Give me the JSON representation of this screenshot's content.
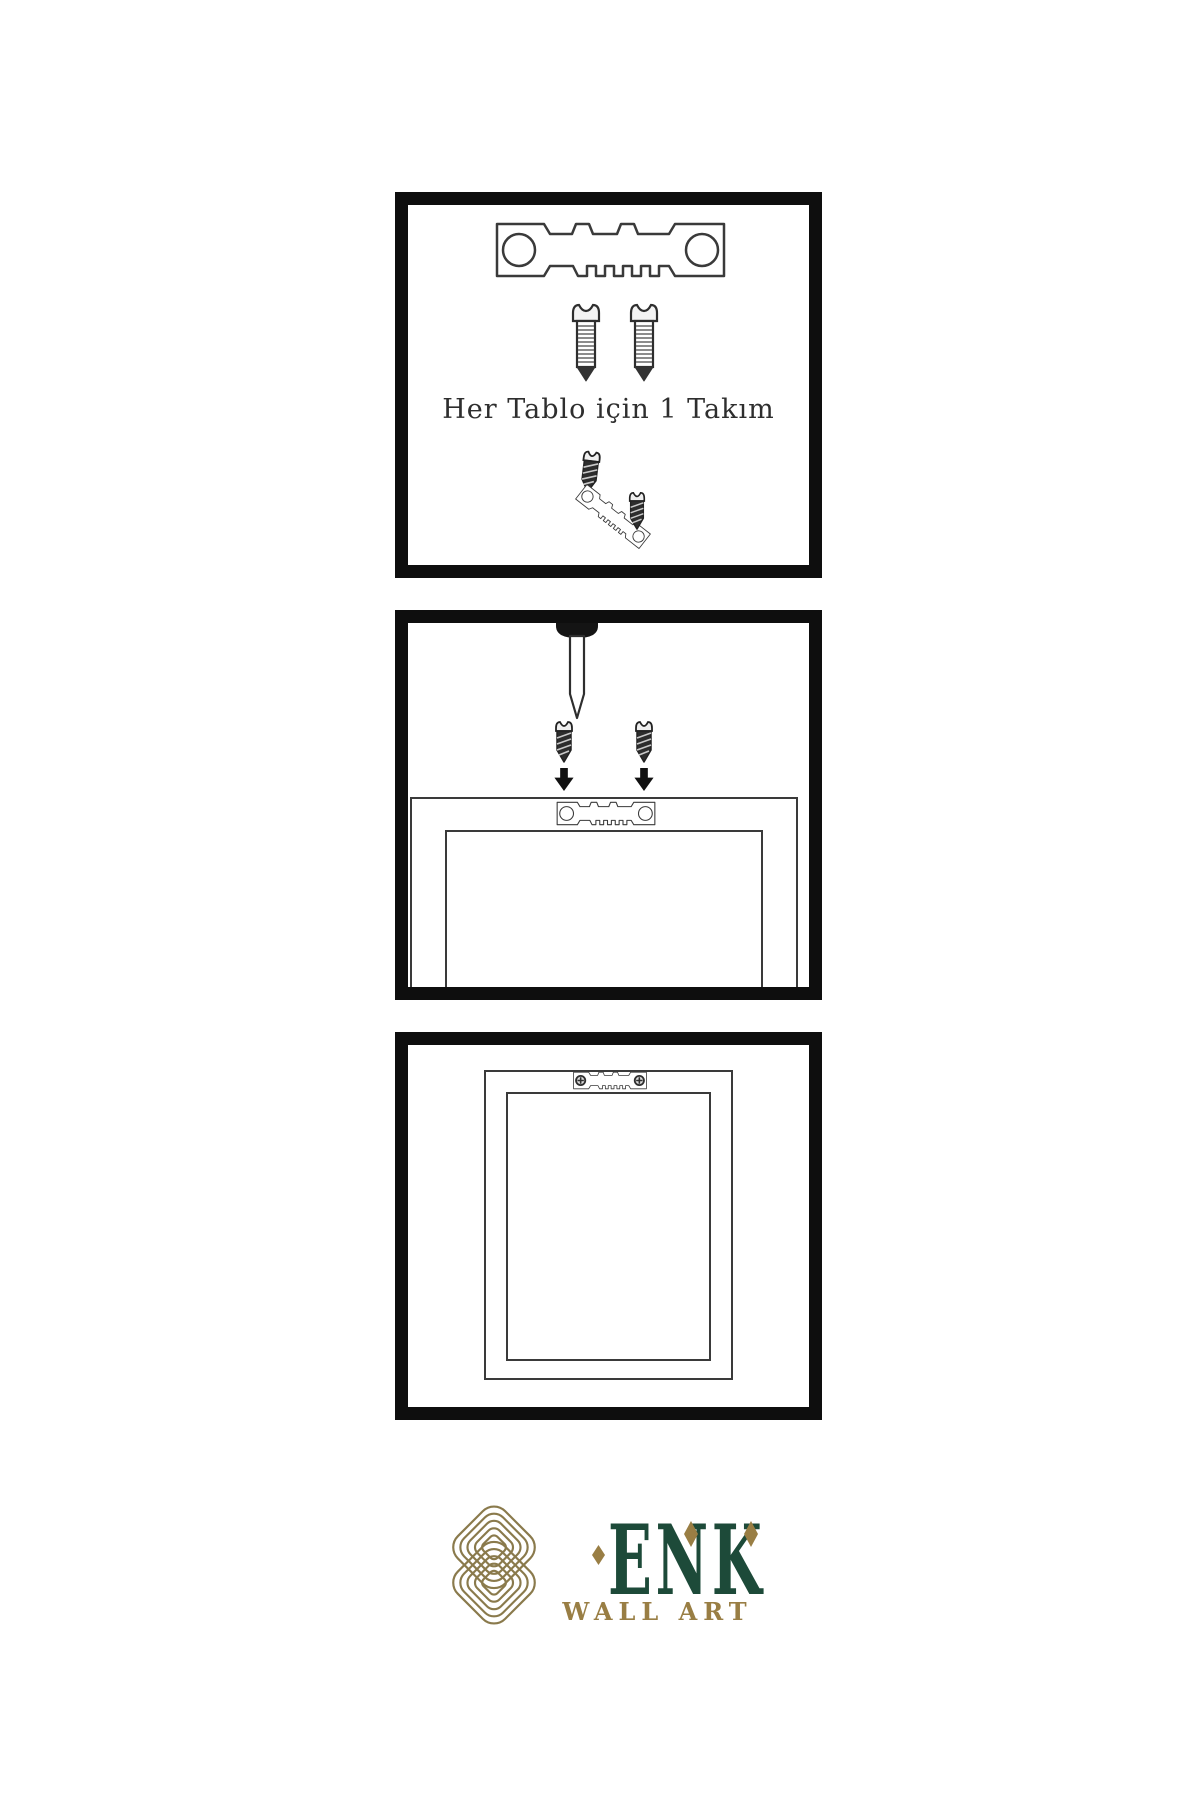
{
  "colors": {
    "border": "#0e0e0e",
    "line": "#3a3a3a",
    "ink": "#2e2e2e",
    "brand-green": "#1d4a39",
    "brand-gold": "#997e44",
    "knot-gold": "#8a7a4c",
    "screw-dark": "#2d2d2d"
  },
  "steps": [
    {
      "id": "kit-contents",
      "caption": "Her Tablo için 1 Takım",
      "items": [
        "sawtooth-hanger-plate",
        "mounting-screw",
        "mounting-screw",
        "mounting-screw",
        "tilted-sawtooth-hanger",
        "mounting-screw"
      ]
    },
    {
      "id": "attach-hanger",
      "caption": "",
      "items": [
        "wall-nail",
        "mounting-screw",
        "mounting-screw",
        "down-arrow",
        "down-arrow",
        "picture-frame-back",
        "sawtooth-hanger-plate"
      ]
    },
    {
      "id": "hang-frame",
      "caption": "",
      "items": [
        "picture-frame-back",
        "sawtooth-hanger-plate-screwed"
      ]
    }
  ],
  "brand": {
    "name": "ENK",
    "subtitle": "WALL ART"
  }
}
